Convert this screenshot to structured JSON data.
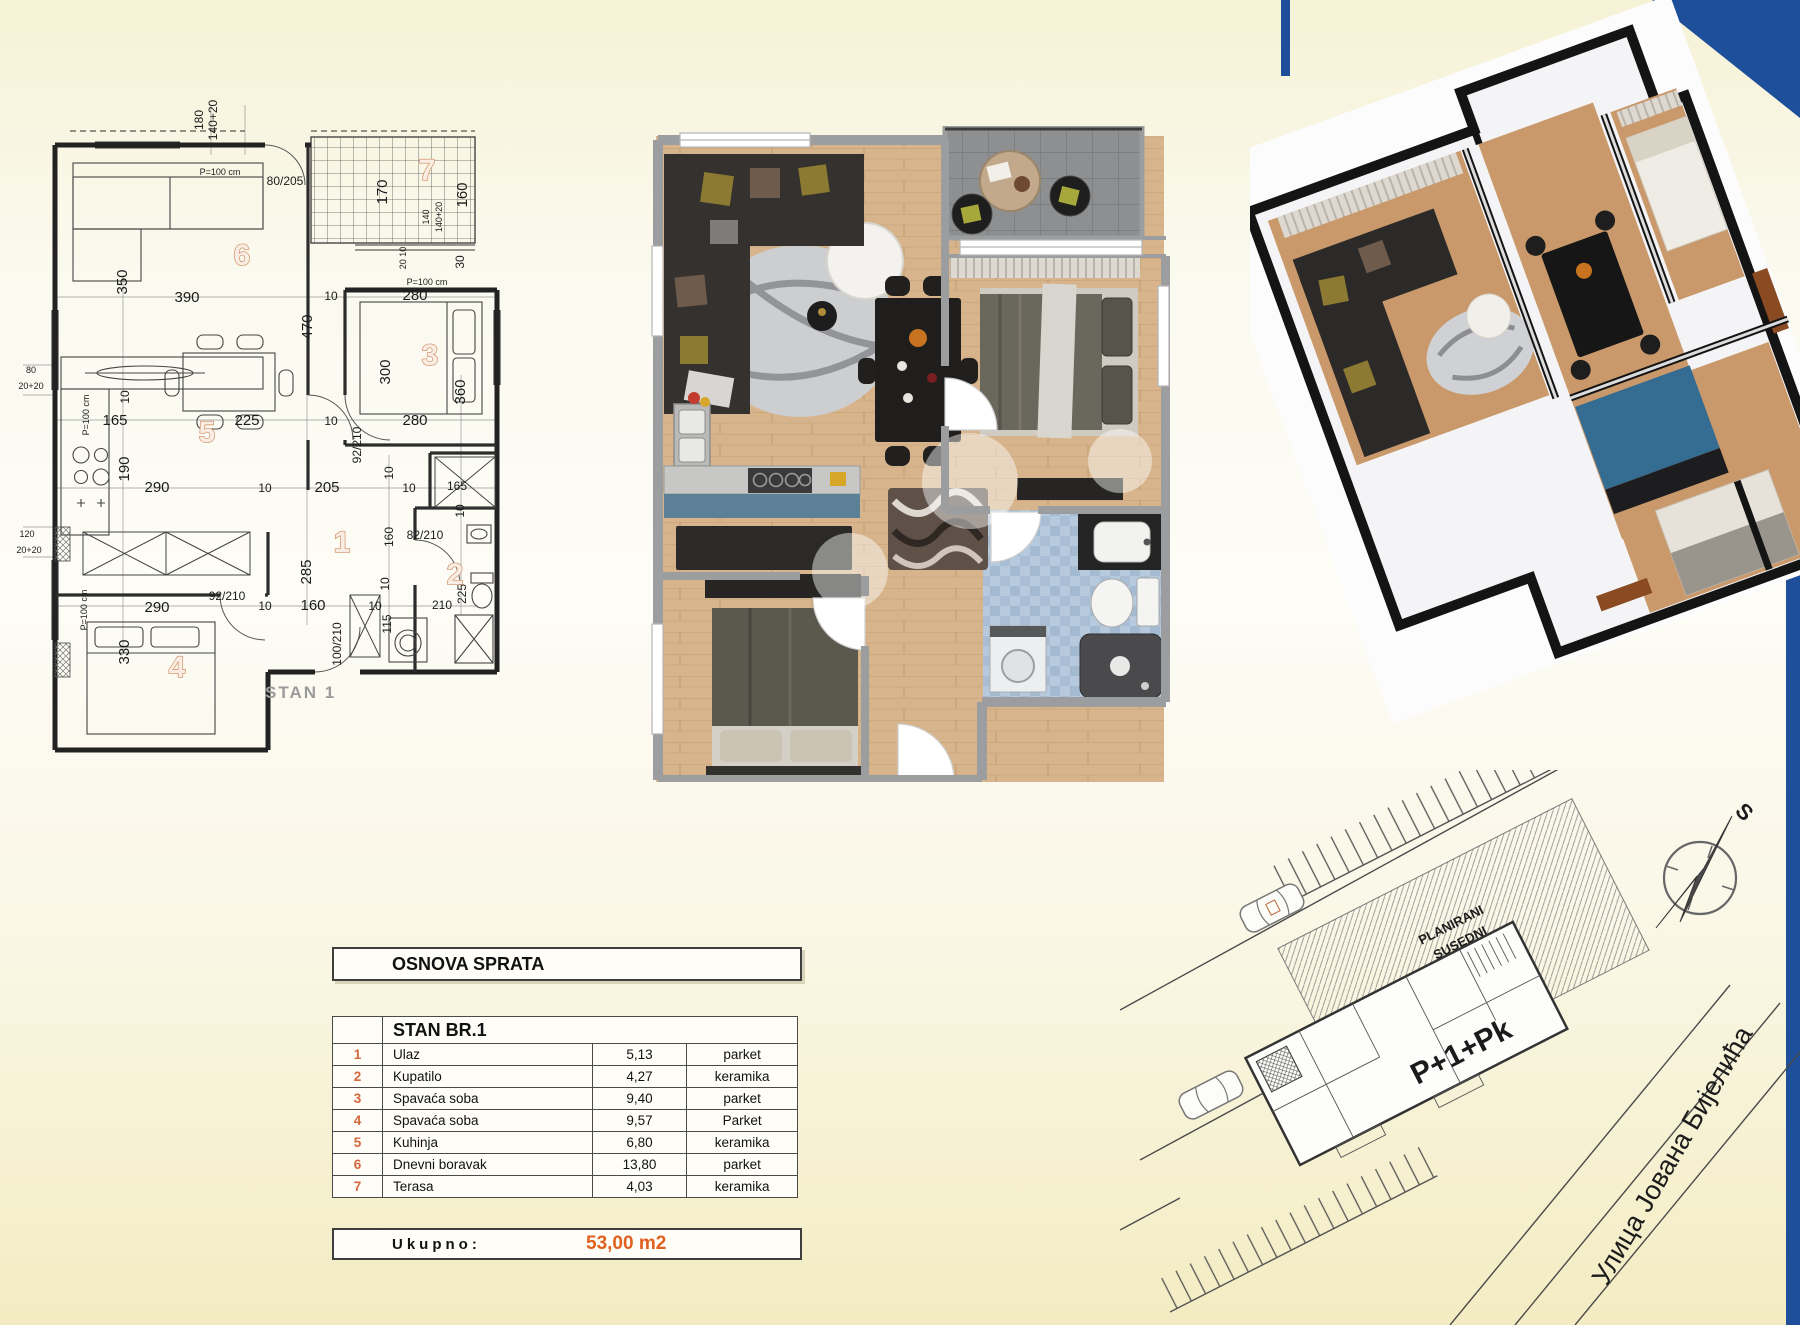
{
  "tech_plan": {
    "stan_label": "STAN 1",
    "rooms": [
      "1",
      "2",
      "3",
      "4",
      "5",
      "6",
      "7"
    ],
    "dims": [
      "180",
      "140+20",
      "P=100 cm",
      "80/205",
      "170",
      "160",
      "140",
      "140+20",
      "20 10",
      "30",
      "P=100 cm",
      "10",
      "280",
      "350",
      "390",
      "470",
      "300",
      "360",
      "280",
      "10",
      "80",
      "20+20",
      "P=100 cm",
      "10",
      "165",
      "225",
      "190",
      "290",
      "10",
      "205",
      "10",
      "10",
      "165",
      "92/210",
      "10",
      "82/210",
      "160",
      "285",
      "10",
      "225",
      "210",
      "115",
      "10",
      "160",
      "10",
      "100/210",
      "92/210",
      "120",
      "20+20",
      "290",
      "330",
      "P=100 cm"
    ]
  },
  "area_table": {
    "sheet_title": "OSNOVA SPRATA",
    "unit_title": "STAN BR.1",
    "rows": [
      {
        "num": "1",
        "name": "Ulaz",
        "area": "5,13",
        "floor": "parket"
      },
      {
        "num": "2",
        "name": "Kupatilo",
        "area": "4,27",
        "floor": "keramika"
      },
      {
        "num": "3",
        "name": "Spavaća soba",
        "area": "9,40",
        "floor": "parket"
      },
      {
        "num": "4",
        "name": "Spavaća soba",
        "area": "9,57",
        "floor": "Parket"
      },
      {
        "num": "5",
        "name": "Kuhinja",
        "area": "6,80",
        "floor": "keramika"
      },
      {
        "num": "6",
        "name": "Dnevni boravak",
        "area": "13,80",
        "floor": "parket"
      },
      {
        "num": "7",
        "name": "Terasa",
        "area": "4,03",
        "floor": "keramika"
      }
    ],
    "total_label": "Ukupno:",
    "total_value": "53,00 m2"
  },
  "site_plan": {
    "neighbor_line1": "PLANIRANI",
    "neighbor_line2": "SUSEDNI",
    "neighbor_line3": "OBJEKAT P+1+Pk",
    "building_label": "P+1+Pk",
    "street_name": "Улица Јована Бијелића",
    "compass_label": "S"
  },
  "colors": {
    "accent_blue": "#1d4f9b",
    "room_number_orange": "#cf8a60",
    "table_number_orange": "#d4663c",
    "total_orange": "#e0611f",
    "site_text_red": "#b34a30",
    "kitchen_blue": "#5d8099"
  }
}
